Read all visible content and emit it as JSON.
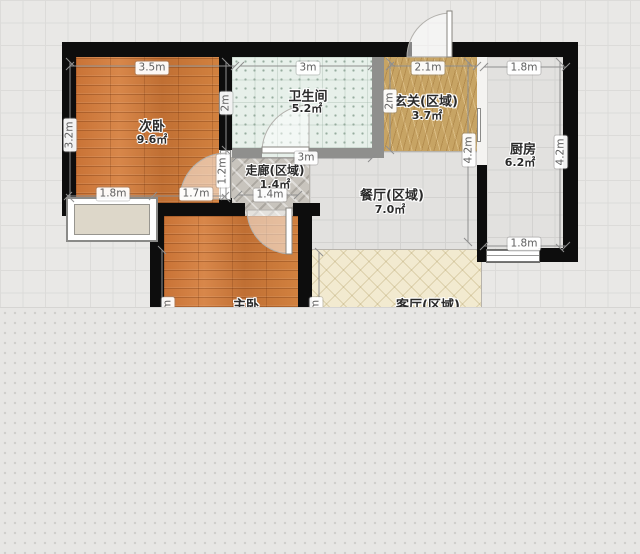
{
  "view": {
    "type": "floor-plan-canvas"
  },
  "rooms": {
    "bedroom2": {
      "name": "次卧",
      "area": "9.6㎡"
    },
    "bathroom": {
      "name": "卫生间",
      "area": "5.2㎡"
    },
    "entry": {
      "name": "玄关(区域)",
      "area": "3.7㎡"
    },
    "corridor": {
      "name": "走廊(区域)",
      "area": "1.4㎡"
    },
    "dining": {
      "name": "餐厅(区域)",
      "area": "7.0㎡"
    },
    "kitchen": {
      "name": "厨房",
      "area": "6.2㎡"
    },
    "bedroom1": {
      "name": "主卧"
    },
    "living": {
      "name": "客厅(区域)"
    }
  },
  "dimensions": {
    "bedroom2_width": "3.5m",
    "bedroom2_height": "3.2m",
    "bedroom2_right_upper": "2m",
    "bedroom2_right_lower": "1.2m",
    "bedroom2_bottom_left": "1.8m",
    "bedroom2_bottom_right": "1.7m",
    "bathroom_width_top": "3m",
    "corridor_span": "3m",
    "corridor_door": "1.4m",
    "entry_width": "2.1m",
    "entry_left_height": "2m",
    "dining_height": "4.2m",
    "kitchen_width_top": "1.8m",
    "kitchen_height": "4.2m",
    "kitchen_window": "1.8m",
    "clipped_label_bedroom1": "m",
    "clipped_label_living": "m"
  },
  "colors": {
    "wall": "#0d0d0d",
    "wood_floor": "#cb7c3f",
    "bath_tile": "#e7f0ea",
    "entry_marble": "#c7a464",
    "living_floor": "#f2ead0",
    "grid_bg": "#e9e8e6"
  }
}
